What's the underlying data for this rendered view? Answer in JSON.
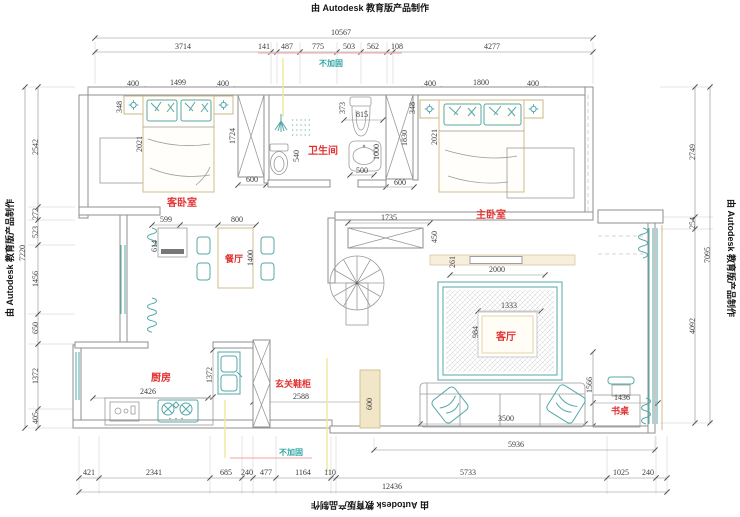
{
  "watermark": {
    "text": "由 Autodesk 教育版产品制作"
  },
  "notes": {
    "top": "不加固",
    "bottom": "不加固"
  },
  "rooms": {
    "guest_bedroom": "客卧室",
    "bathroom": "卫生间",
    "master_bedroom": "主卧室",
    "dining": "餐厅",
    "kitchen": "厨房",
    "entry": "玄关鞋柜",
    "living": "客厅",
    "desk": "书桌"
  },
  "dims": {
    "top_total": "10567",
    "top_segs": [
      "3714",
      "141",
      "487",
      "775",
      "503",
      "562",
      "108",
      "4277"
    ],
    "left_total": "7220",
    "left_segs": [
      "2542",
      "272",
      "523",
      "1456",
      "650",
      "1372",
      "405"
    ],
    "right_total": "7095",
    "right_segs": [
      "2749",
      "254",
      "4092"
    ],
    "bottom_total": "12436",
    "bottom_segs": [
      "421",
      "2341",
      "685",
      "240",
      "477",
      "1164",
      "110",
      "5733",
      "1025",
      "240"
    ],
    "guest": {
      "ns_l": "400",
      "bed": "1499",
      "ns_r": "400",
      "side": "348",
      "depth": "2021",
      "ward_h": "1724",
      "ward_w": "600"
    },
    "master": {
      "ns_l": "400",
      "bed": "1800",
      "ns_r": "400",
      "side": "348",
      "depth": "2021",
      "ward_h": "1830",
      "ward_w": "600"
    },
    "bath": {
      "niche": "373",
      "top": "815",
      "toilet": "540",
      "basin": "1000",
      "basin_w": "500"
    },
    "hall": {
      "left": "599",
      "table": "800",
      "door": "614",
      "table_h": "1400",
      "cabinet": "1735",
      "depth": "450",
      "gap": "261",
      "tv": "2000"
    },
    "living": {
      "rug_w": "1333",
      "rug_h": "984",
      "side": "1566",
      "desk": "1436",
      "sofa": "3500",
      "width": "5936"
    },
    "kitchen": {
      "w": "2426",
      "h": "1372"
    },
    "entry": {
      "cabinet": "2588",
      "pillar": "600"
    }
  }
}
